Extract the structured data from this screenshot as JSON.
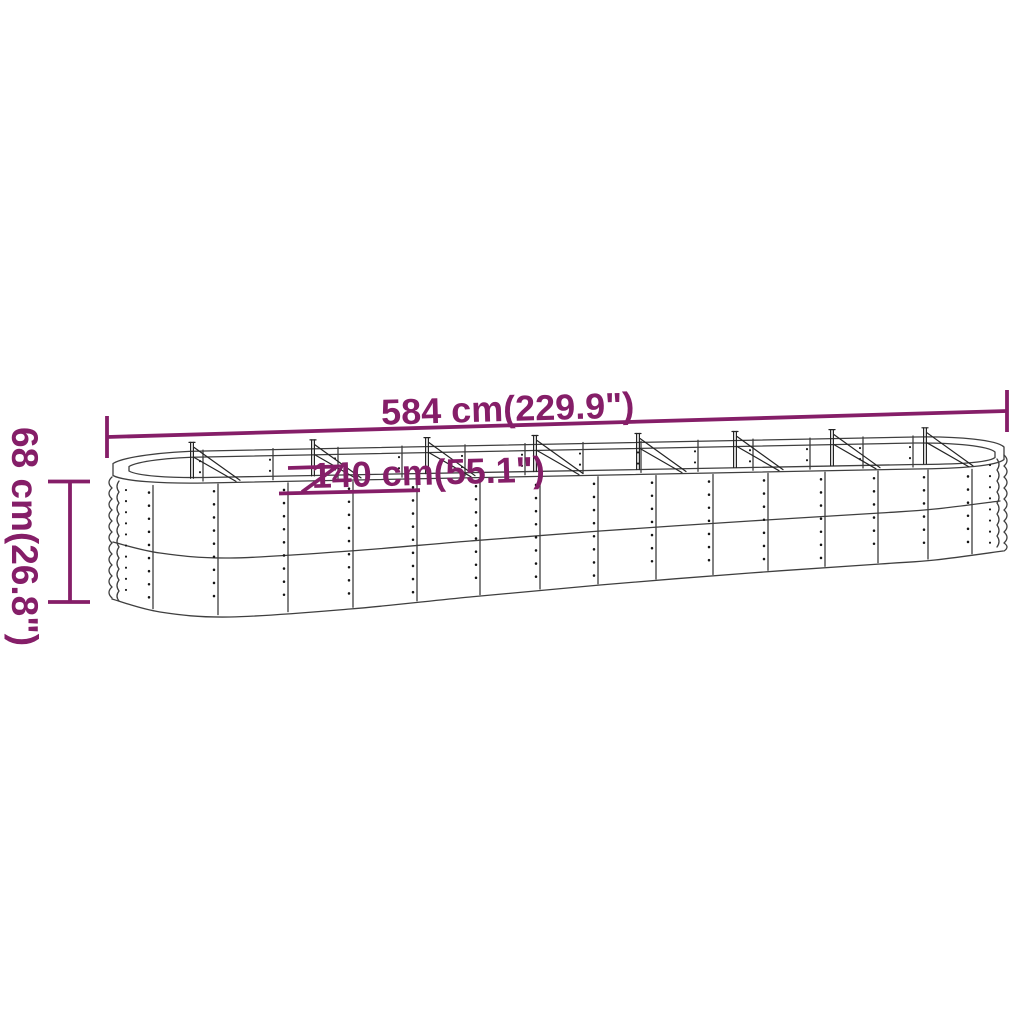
{
  "page": {
    "background": "#ffffff"
  },
  "diagram": {
    "subject": "oval-raised-garden-bed-line-drawing",
    "dimension_color": "#851e68",
    "line_color": "#3f3f3f",
    "labels": {
      "length": "584 cm(229.9\")",
      "width": "140 cm(55.1\")",
      "height": "68 cm(26.8\")"
    }
  }
}
